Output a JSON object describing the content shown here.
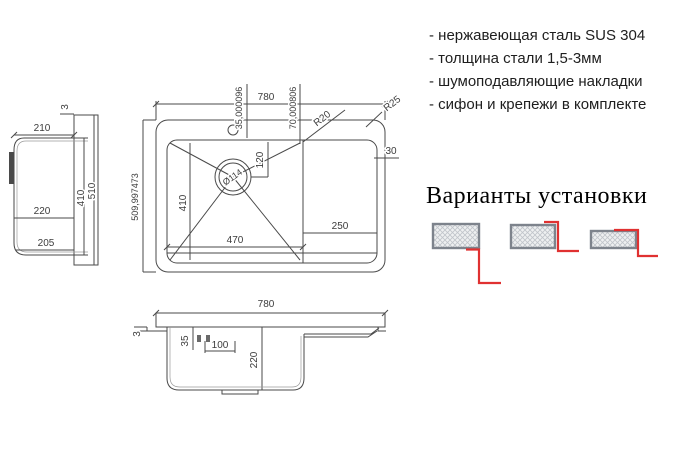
{
  "specs": {
    "items": [
      "- нержавеющая сталь SUS 304",
      "- толщина стали 1,5-3мм",
      "- шумоподавляющие накладки",
      "- сифон и крепежи в комплекте"
    ]
  },
  "installation": {
    "title": "Варианты установки"
  },
  "top_view": {
    "overall_width": "780",
    "hole_dim_a": "35,000096",
    "hole_dim_b": "70,000806",
    "radius_outer": "R25",
    "radius_inner": "R20",
    "rim_width": "30",
    "drain_offset": "120",
    "drain_diameter": "Ø114",
    "bowl_length": "470",
    "bowl_width": "410",
    "wing_width": "250",
    "overall_depth": "509,997473"
  },
  "side_view": {
    "lip": "3",
    "top_width": "210",
    "mid_width": "220",
    "bottom_width": "205",
    "inner_depth": "410",
    "overall_depth": "510"
  },
  "front_view": {
    "overall_width": "780",
    "lip": "3",
    "clip_drop": "35",
    "clip_span": "100",
    "bowl_depth": "220"
  },
  "colors": {
    "line": "#4a4a4a",
    "accent_red": "#e03131",
    "hatch_border": "#7d838c"
  }
}
